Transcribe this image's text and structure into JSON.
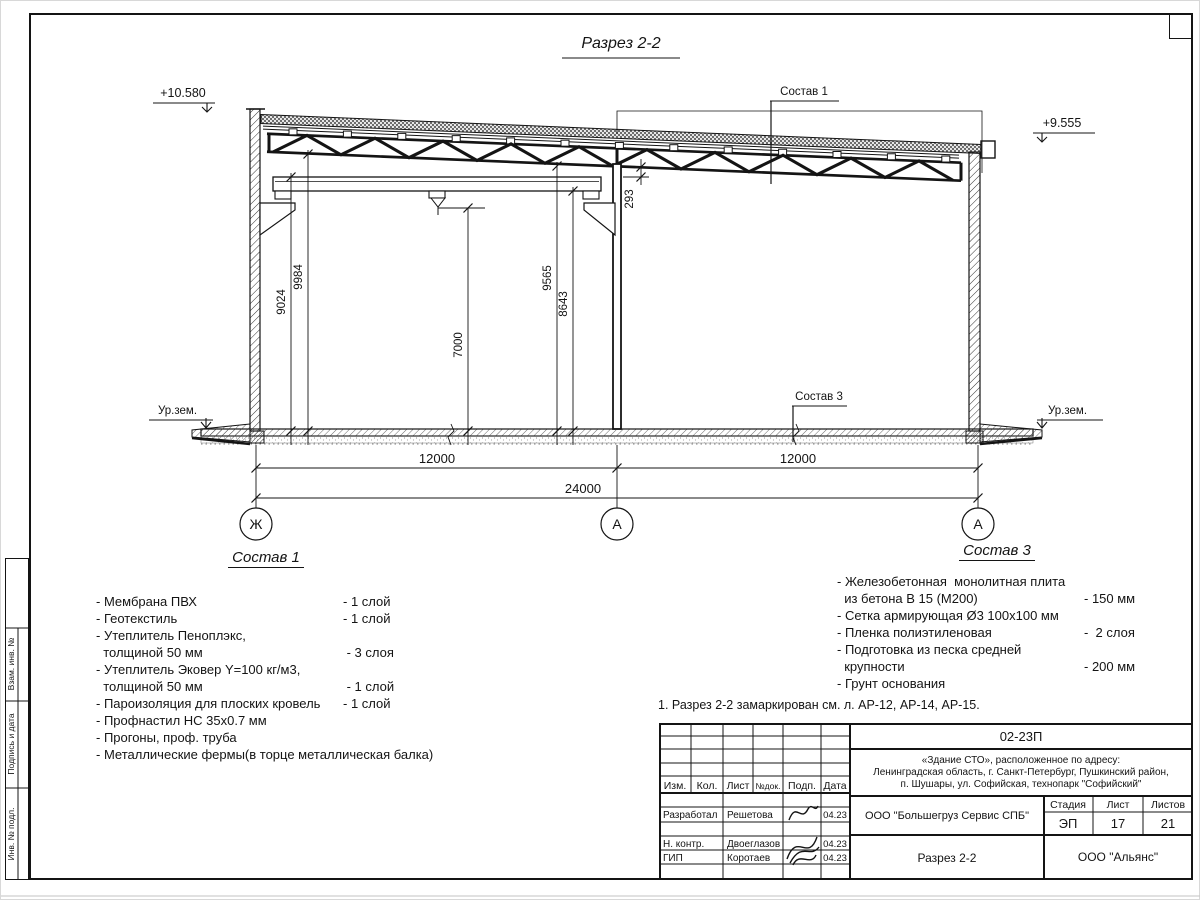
{
  "drawing": {
    "title": "Разрез 2-2",
    "elevation_left": "+10.580",
    "elevation_right": "+9.555",
    "callout_roof": "Состав 1",
    "callout_slab": "Состав 3",
    "ground_left": "Ур.зем.",
    "ground_right": "Ур.зем.",
    "dims": {
      "left_outer": "9024",
      "left_inner": "9984",
      "hook_height": "7000",
      "mid_inner": "9565",
      "mid_outer": "8643",
      "truss_gap": "293",
      "span_left": "12000",
      "span_right": "12000",
      "total": "24000"
    },
    "axes": {
      "left": "Ж",
      "mid": "А",
      "right": "А"
    }
  },
  "sostav1": {
    "title": "Состав 1",
    "items": [
      {
        "text": "- Мембрана ПВХ",
        "value": "- 1 слой"
      },
      {
        "text": "- Геотекстиль",
        "value": "- 1 слой"
      },
      {
        "text": "- Утеплитель Пеноплэкс,",
        "value": ""
      },
      {
        "text": "  толщиной 50 мм",
        "value": " - 3 слоя"
      },
      {
        "text": "- Утеплитель Эковер Y=100 кг/м3,",
        "value": ""
      },
      {
        "text": "  толщиной 50 мм",
        "value": " - 1 слой"
      },
      {
        "text": "- Пароизоляция для плоских кровель",
        "value": "- 1 слой"
      },
      {
        "text": "- Профнастил НС 35х0.7 мм",
        "value": ""
      },
      {
        "text": "- Прогоны, проф. труба",
        "value": ""
      },
      {
        "text": "- Металлические фермы(в торце металлическая балка)",
        "value": ""
      }
    ]
  },
  "sostav3": {
    "title": "Состав 3",
    "items": [
      {
        "text": "- Железобетонная  монолитная плита",
        "value": ""
      },
      {
        "text": "  из бетона В 15 (М200)",
        "value": "- 150 мм"
      },
      {
        "text": "- Сетка армирующая Ø3 100х100 мм",
        "value": ""
      },
      {
        "text": "- Пленка полиэтиленовая",
        "value": "-  2 слоя"
      },
      {
        "text": "- Подготовка из песка средней",
        "value": ""
      },
      {
        "text": "  крупности",
        "value": "- 200 мм"
      },
      {
        "text": "- Грунт основания",
        "value": ""
      }
    ]
  },
  "note": "1. Разрез 2-2 замаркирован см. л. АР-12, АР-14, АР-15.",
  "titleblock": {
    "doc_number": "02-23П",
    "address_line1": "«Здание СТО», расположенное по адресу:",
    "address_line2": "Ленинградская область, г. Санкт-Петербург, Пушкинский район,",
    "address_line3": "п. Шушары, ул. Софийская, технопарк \"Софийский\"",
    "cols": {
      "izm": "Изм.",
      "kol": "Кол.",
      "list": "Лист",
      "ndok": "№док.",
      "podp": "Подп.",
      "data": "Дата"
    },
    "rows": [
      {
        "role": "Разработал",
        "name": "Решетова",
        "date": "04.23"
      },
      {
        "role": "Н. контр.",
        "name": "Двоеглазов",
        "date": "04.23"
      },
      {
        "role": "ГИП",
        "name": "Коротаев",
        "date": "04.23"
      }
    ],
    "company": "ООО \"Большегруз Сервис СПБ\"",
    "stage_label": "Стадия",
    "sheet_label": "Лист",
    "sheets_label": "Листов",
    "stage": "ЭП",
    "sheet": "17",
    "sheets": "21",
    "sheet_title": "Разрез 2-2",
    "org": "ООО \"Альянс\""
  },
  "side_stamp": {
    "cell1": "Взам. инв. №",
    "cell2": "Подпись и дата",
    "cell3": "Инв. № подл."
  }
}
